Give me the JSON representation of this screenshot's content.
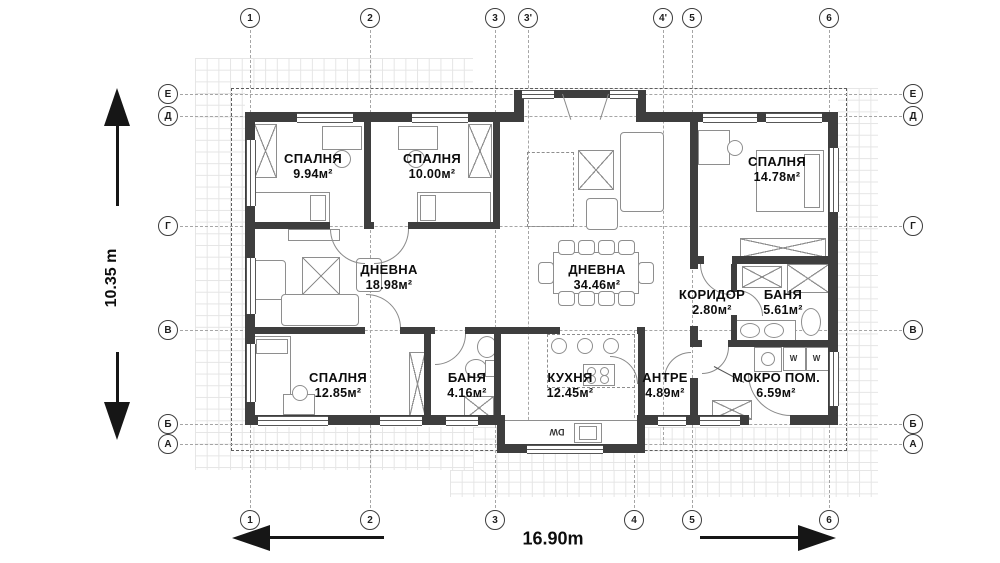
{
  "plan": {
    "dimension_height": "10.35 m",
    "dimension_width": "16.90m",
    "axes": {
      "top": [
        "1",
        "2",
        "3",
        "3'",
        "4'",
        "5",
        "6"
      ],
      "bottom": [
        "1",
        "2",
        "3",
        "4",
        "5",
        "6"
      ],
      "left": [
        "Е",
        "Д",
        "Г",
        "В",
        "Б",
        "А"
      ],
      "right": [
        "Е",
        "Д",
        "Г",
        "В",
        "Б",
        "А"
      ]
    },
    "rooms": [
      {
        "name": "СПАЛНЯ",
        "area": "9.94м²"
      },
      {
        "name": "СПАЛНЯ",
        "area": "10.00м²"
      },
      {
        "name": "СПАЛНЯ",
        "area": "14.78м²"
      },
      {
        "name": "ДНЕВНА",
        "area": "18.98м²"
      },
      {
        "name": "ДНЕВНА",
        "area": "34.46м²"
      },
      {
        "name": "КОРИДОР",
        "area": "2.80м²"
      },
      {
        "name": "БАНЯ",
        "area": "5.61м²"
      },
      {
        "name": "СПАЛНЯ",
        "area": "12.85м²"
      },
      {
        "name": "БАНЯ",
        "area": "4.16м²"
      },
      {
        "name": "КУХНЯ",
        "area": "12.45м²"
      },
      {
        "name": "АНТРЕ",
        "area": "4.89м²"
      },
      {
        "name": "МОКРО ПОМ.",
        "area": "6.59м²"
      }
    ],
    "appliances": {
      "washer1": "W",
      "washer2": "W",
      "dishwasher": "DW"
    },
    "colors": {
      "wall": "#3e3e3e",
      "grid_line": "#e5e5e5",
      "dimension": "#161616"
    }
  }
}
